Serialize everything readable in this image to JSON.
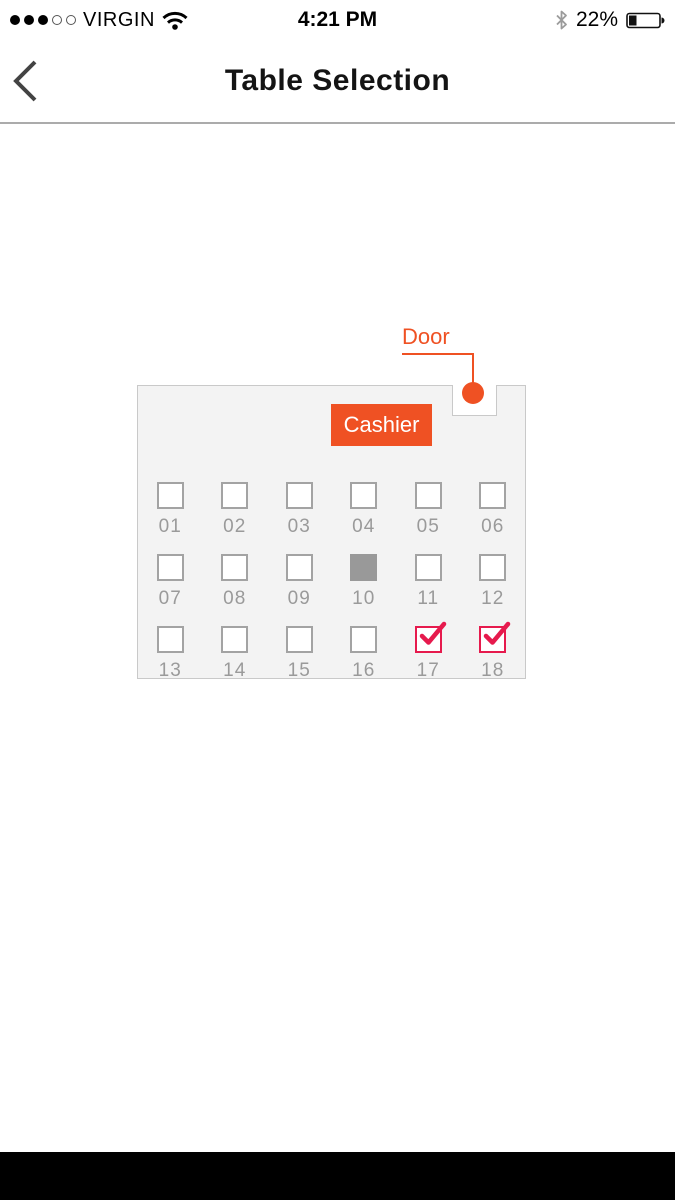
{
  "status_bar": {
    "carrier": "VIRGIN",
    "time": "4:21 PM",
    "battery_percent": "22%",
    "signal_filled_dots": 3,
    "signal_empty_dots": 2
  },
  "nav_bar": {
    "title": "Table Selection"
  },
  "floor_plan": {
    "door_label": "Door",
    "cashier_label": "Cashier",
    "tables": [
      {
        "id": "01",
        "state": "available"
      },
      {
        "id": "02",
        "state": "available"
      },
      {
        "id": "03",
        "state": "available"
      },
      {
        "id": "04",
        "state": "available"
      },
      {
        "id": "05",
        "state": "available"
      },
      {
        "id": "06",
        "state": "available"
      },
      {
        "id": "07",
        "state": "available"
      },
      {
        "id": "08",
        "state": "available"
      },
      {
        "id": "09",
        "state": "available"
      },
      {
        "id": "10",
        "state": "occupied"
      },
      {
        "id": "11",
        "state": "available"
      },
      {
        "id": "12",
        "state": "available"
      },
      {
        "id": "13",
        "state": "available"
      },
      {
        "id": "14",
        "state": "available"
      },
      {
        "id": "15",
        "state": "available"
      },
      {
        "id": "16",
        "state": "available"
      },
      {
        "id": "17",
        "state": "selected"
      },
      {
        "id": "18",
        "state": "selected"
      }
    ]
  },
  "colors": {
    "accent_orange": "#EF5123",
    "selected_red": "#E61A4D",
    "occupied_gray": "#999999",
    "floor_bg": "#F3F3F3",
    "floor_border": "#C9C9C9",
    "label_gray": "#9A9A9A"
  }
}
